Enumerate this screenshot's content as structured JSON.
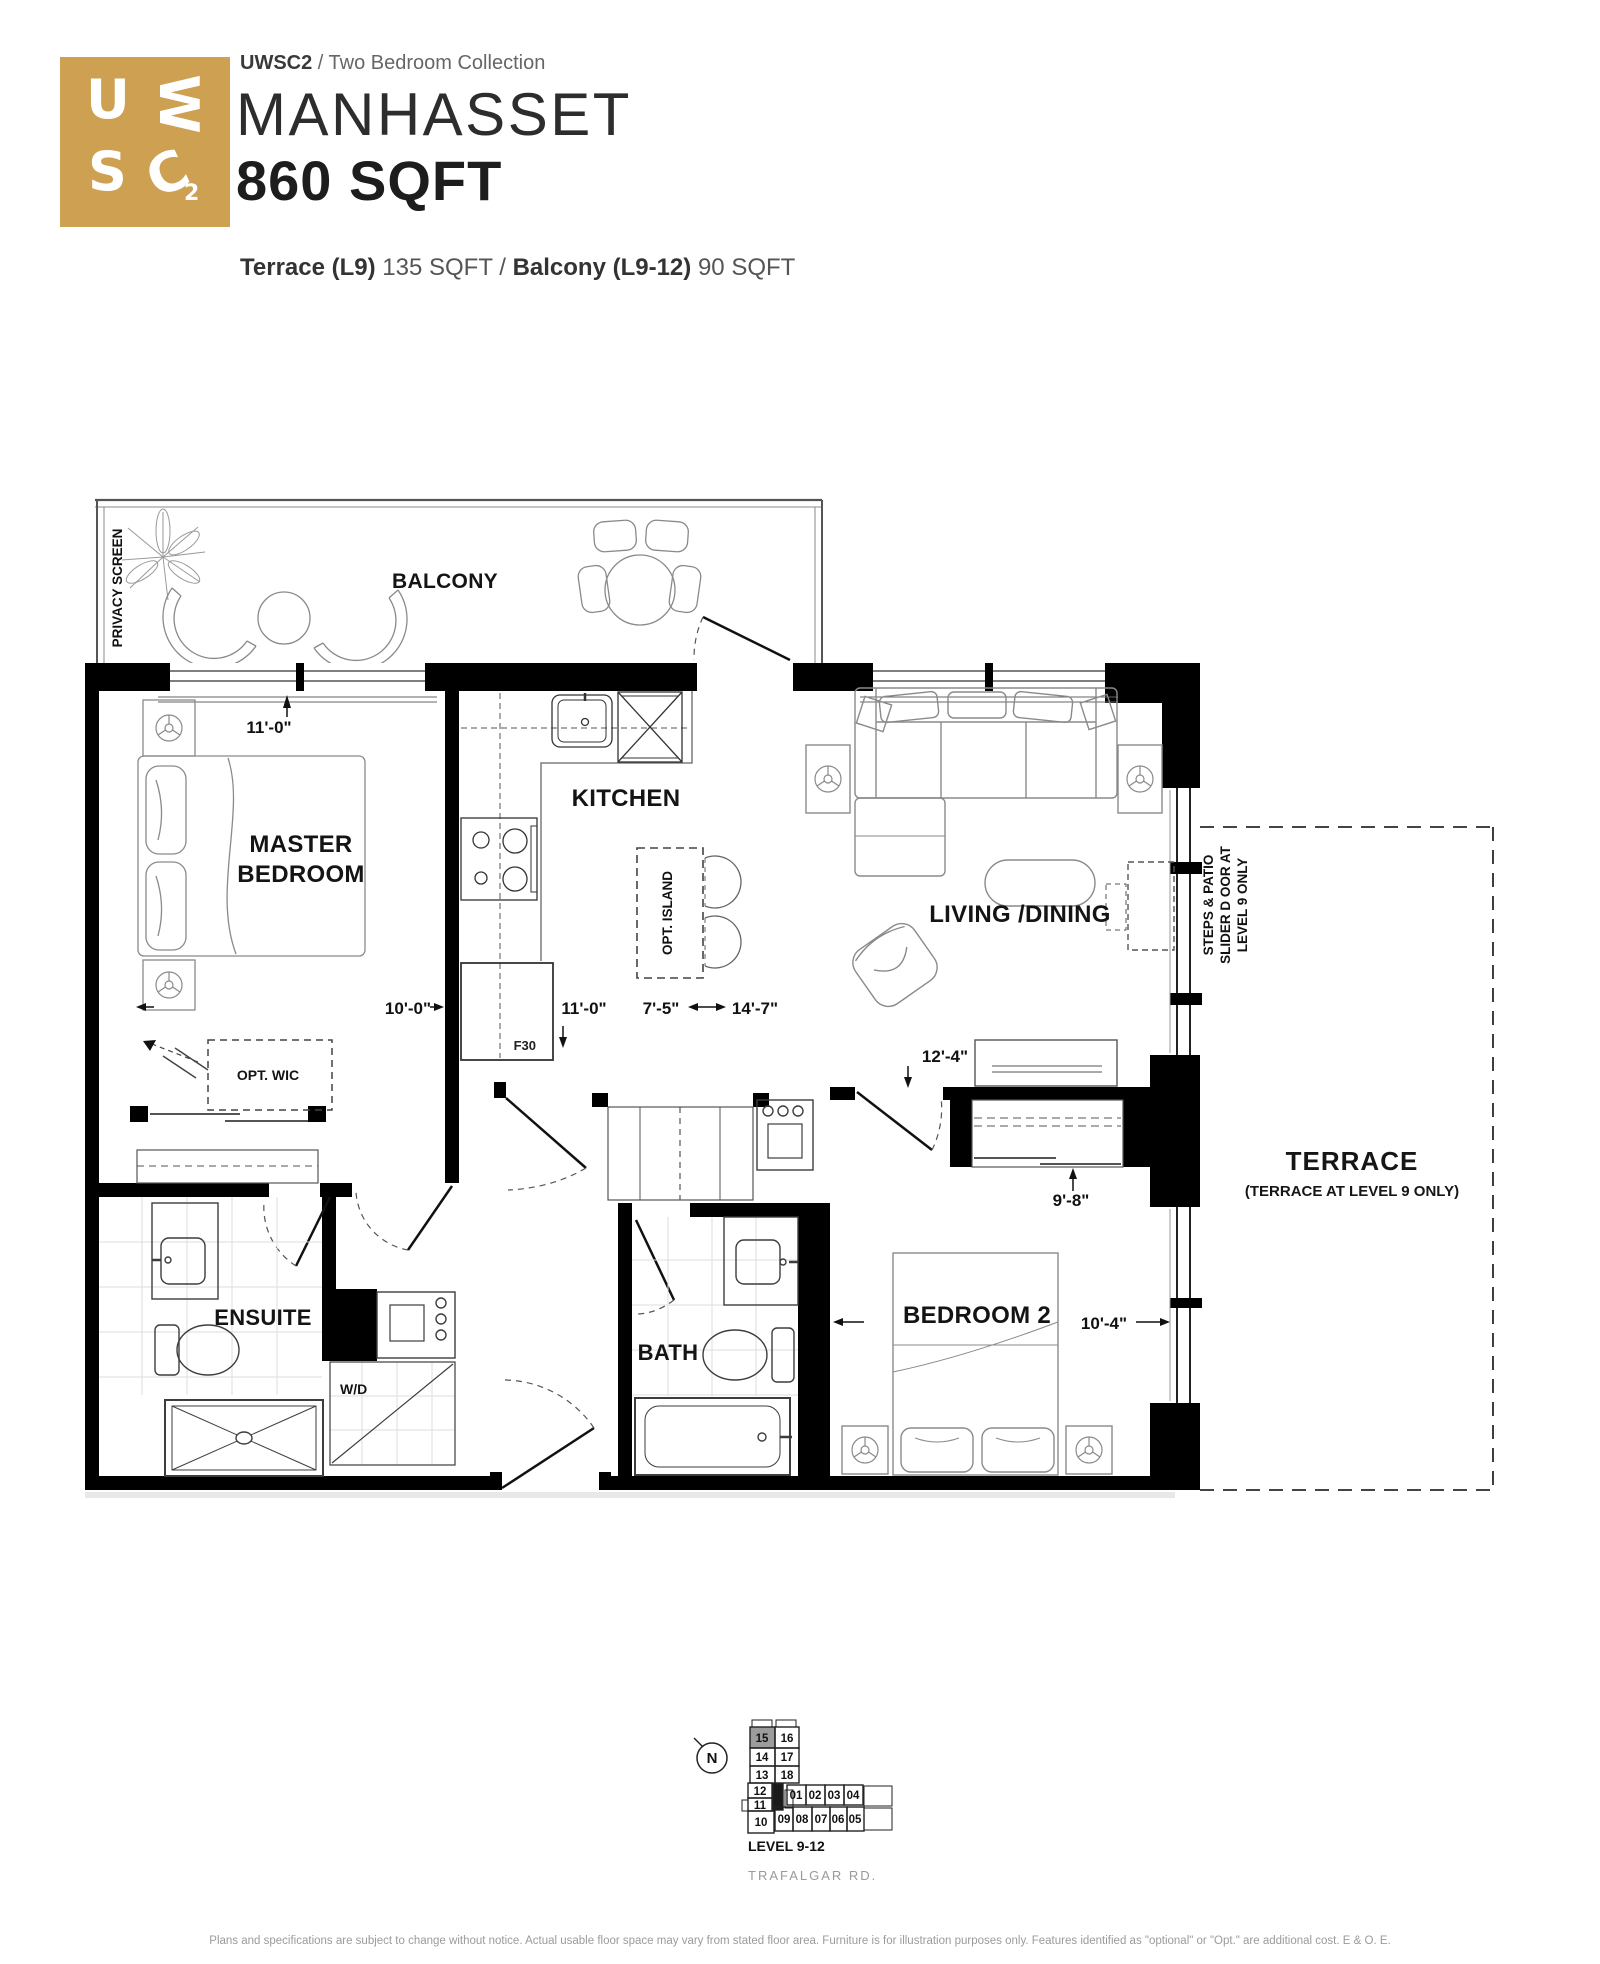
{
  "colors": {
    "brand_gold": "#CEA052",
    "wall_black": "#000000",
    "keyplan_highlight": "#9C9C9C"
  },
  "header": {
    "logo": {
      "l1": "U",
      "l2": "W",
      "l3": "S",
      "l4": "C",
      "l5": "2"
    },
    "collection_code": "UWSC2",
    "collection_rest": " / Two Bedroom Collection",
    "unit_name": "MANHASSET",
    "unit_size": "860 SQFT",
    "outdoor": {
      "terrace_label": "Terrace (L9)",
      "terrace_rest": " 135 SQFT / ",
      "balcony_label": "Balcony (L9-12)",
      "balcony_rest": " 90 SQFT"
    }
  },
  "plan": {
    "privacy_screen": "PRIVACY SCREEN",
    "balcony": "BALCONY",
    "master_line1": "MASTER",
    "master_line2": "BEDROOM",
    "kitchen": "KITCHEN",
    "opt_island": "OPT. ISLAND",
    "living_dining": "LIVING /DINING",
    "bedroom2": "BEDROOM 2",
    "ensuite": "ENSUITE",
    "bath": "BATH",
    "wd": "W/D",
    "opt_wic": "OPT. WIC",
    "fridge": "F30",
    "terrace": "TERRACE",
    "terrace_note": "(TERRACE AT LEVEL 9 ONLY)",
    "steps_note_line1": "STEPS & PATIO",
    "steps_note_line2": "SLIDER D OOR AT",
    "steps_note_line3": "LEVEL 9 ONLY",
    "dims": {
      "master_width": "11'-0\"",
      "master_depth": "10'-0\"",
      "kitchen_width": "11'-0\"",
      "island_width": "7'-5\"",
      "living_width": "14'-7\"",
      "living_depth": "12'-4\"",
      "bedroom2_width": "9'-8\"",
      "bedroom2_depth": "10'-4\""
    }
  },
  "keyplan": {
    "north": "N",
    "level_label": "LEVEL 9-12",
    "street": "TRAFALGAR RD.",
    "highlighted_unit": "15",
    "units": [
      "15",
      "16",
      "14",
      "17",
      "13",
      "18",
      "12",
      "11",
      "10",
      "01",
      "02",
      "03",
      "04",
      "09",
      "08",
      "07",
      "06",
      "05"
    ]
  },
  "footer": {
    "disclaimer": "Plans and specifications are subject to change without notice. Actual usable floor space may vary from stated floor area. Furniture is for illustration purposes only. Features identified as \"optional\" or \"Opt.\" are additional cost. E & O. E."
  }
}
